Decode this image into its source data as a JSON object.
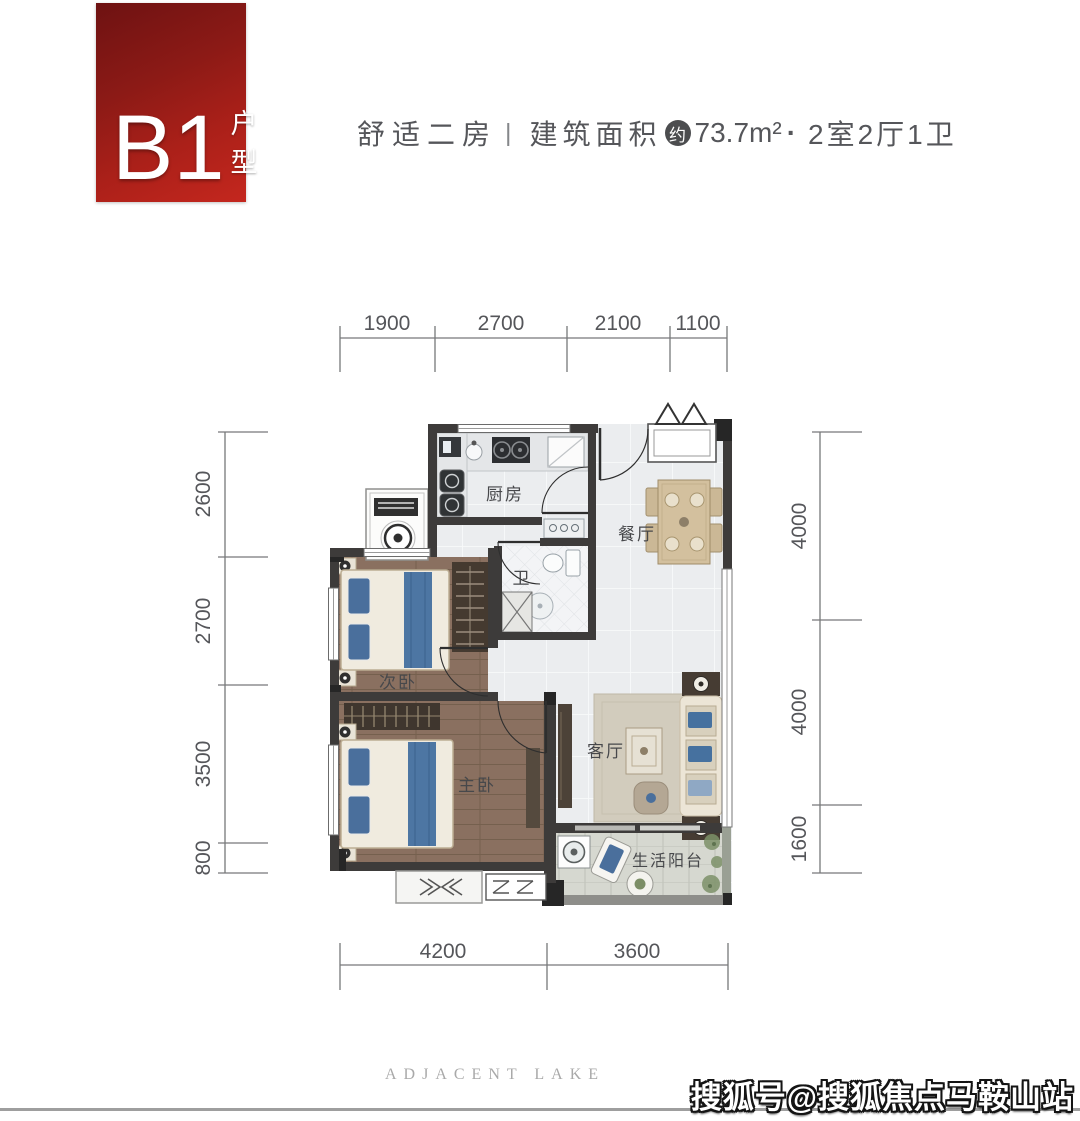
{
  "badge": {
    "code": "B1",
    "suffix": "户型"
  },
  "header": {
    "tagline": "舒适二房",
    "divider": "|",
    "area_label": "建筑面积",
    "approx_badge": "约",
    "area_value": "73.7m²",
    "separator": "·",
    "layout": "2室2厅1卫"
  },
  "plan": {
    "rooms": {
      "kitchen": "厨房",
      "dining": "餐厅",
      "bath": "卫",
      "bedroom2": "次卧",
      "master": "主卧",
      "living": "客厅",
      "balcony": "生活阳台"
    },
    "dims": {
      "top": [
        "1900",
        "2700",
        "2100",
        "1100"
      ],
      "left": [
        "2600",
        "2700",
        "3500",
        "800"
      ],
      "right": [
        "4000",
        "4000",
        "1600"
      ],
      "bottom": [
        "4200",
        "3600"
      ]
    }
  },
  "footer": {
    "brand": "ADJACENT LAKE"
  },
  "watermark": {
    "text": "搜狐号@搜狐焦点马鞍山站"
  },
  "colors": {
    "badge_red_dark": "#6e1212",
    "badge_red": "#c4271e",
    "wall": "#3d3b3a",
    "wood_floor": "#8a7060",
    "light_floor": "#ebedef",
    "balcony_floor": "#d6d8d0",
    "accent_blue": "#4d76a3",
    "dim_text": "#55565a",
    "watermark_fill": "#ffffff",
    "footer_gray": "#a9a9a9"
  }
}
